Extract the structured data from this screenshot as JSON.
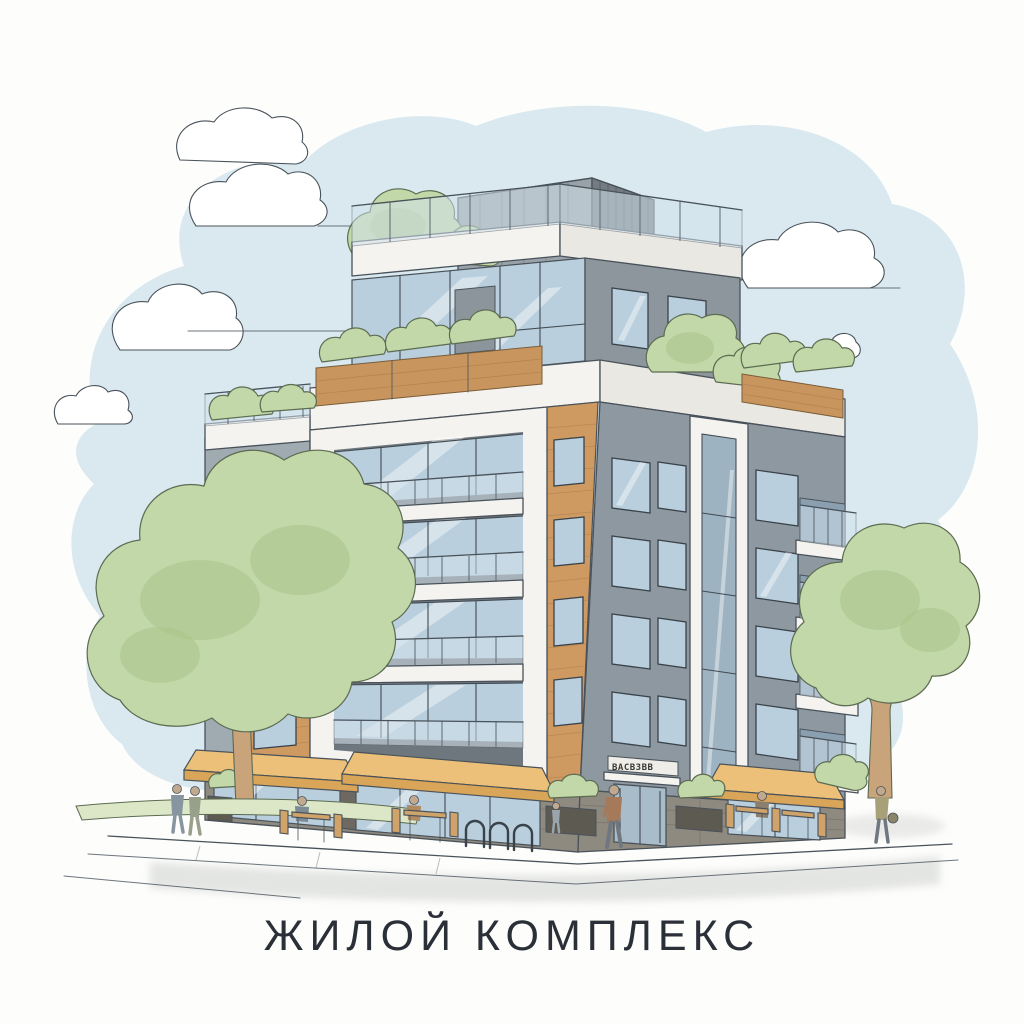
{
  "title": {
    "text": "ЖИЛОЙ КОМПЛЕКС"
  },
  "building": {
    "entrance_sign": "ВАСВЗВВ",
    "floors_visible": 7,
    "elements": [
      "rooftop-mechanical-box",
      "roof-terraces-with-trees",
      "glass-railings",
      "wood-planters",
      "white-balcony-frame",
      "tan-brick-columns",
      "gray-facades",
      "storefront-awnings",
      "entrance-door",
      "stone-base",
      "cafe-seating",
      "bike-rack",
      "street-planters"
    ]
  },
  "scene": {
    "setting": [
      "watercolor-sky",
      "clouds",
      "street-corner",
      "sidewalk",
      "trees-left-right",
      "grass-verge"
    ],
    "people": [
      "pedestrian-pair-left",
      "pedestrian-center",
      "child-near-planter",
      "pedestrian-right-with-bag",
      "cafe-patron-left",
      "cafe-patron-mid",
      "cafe-patron-right"
    ]
  },
  "palette": {
    "paper": "#fdfdfc",
    "sky": "#d9e9ef",
    "cloud": "#ffffff",
    "ink": "#49525a",
    "inkG": "#5c6b51",
    "leaf": "#c2d8a8",
    "leafD": "#a9c48b",
    "grass": "#dbe7c6",
    "trunk": "#c9a37a",
    "wall": "#a0aab1",
    "wallR": "#8e98a0",
    "wallM": "#8d969d",
    "white2": "#f4f3ef",
    "recess": "#6f777e",
    "tan": "#cf9a62",
    "wood": "#c8955e",
    "glass": "#b9cfdd",
    "glass2": "#9db3c2",
    "rail": "#d3e2ec",
    "mull": "#424a52",
    "stone": "#8f8a80",
    "awn": "#ecc078",
    "awnD": "#d9a558",
    "street": "#cfd2cf",
    "title": "#2b3038",
    "figure": "#8795a0"
  }
}
